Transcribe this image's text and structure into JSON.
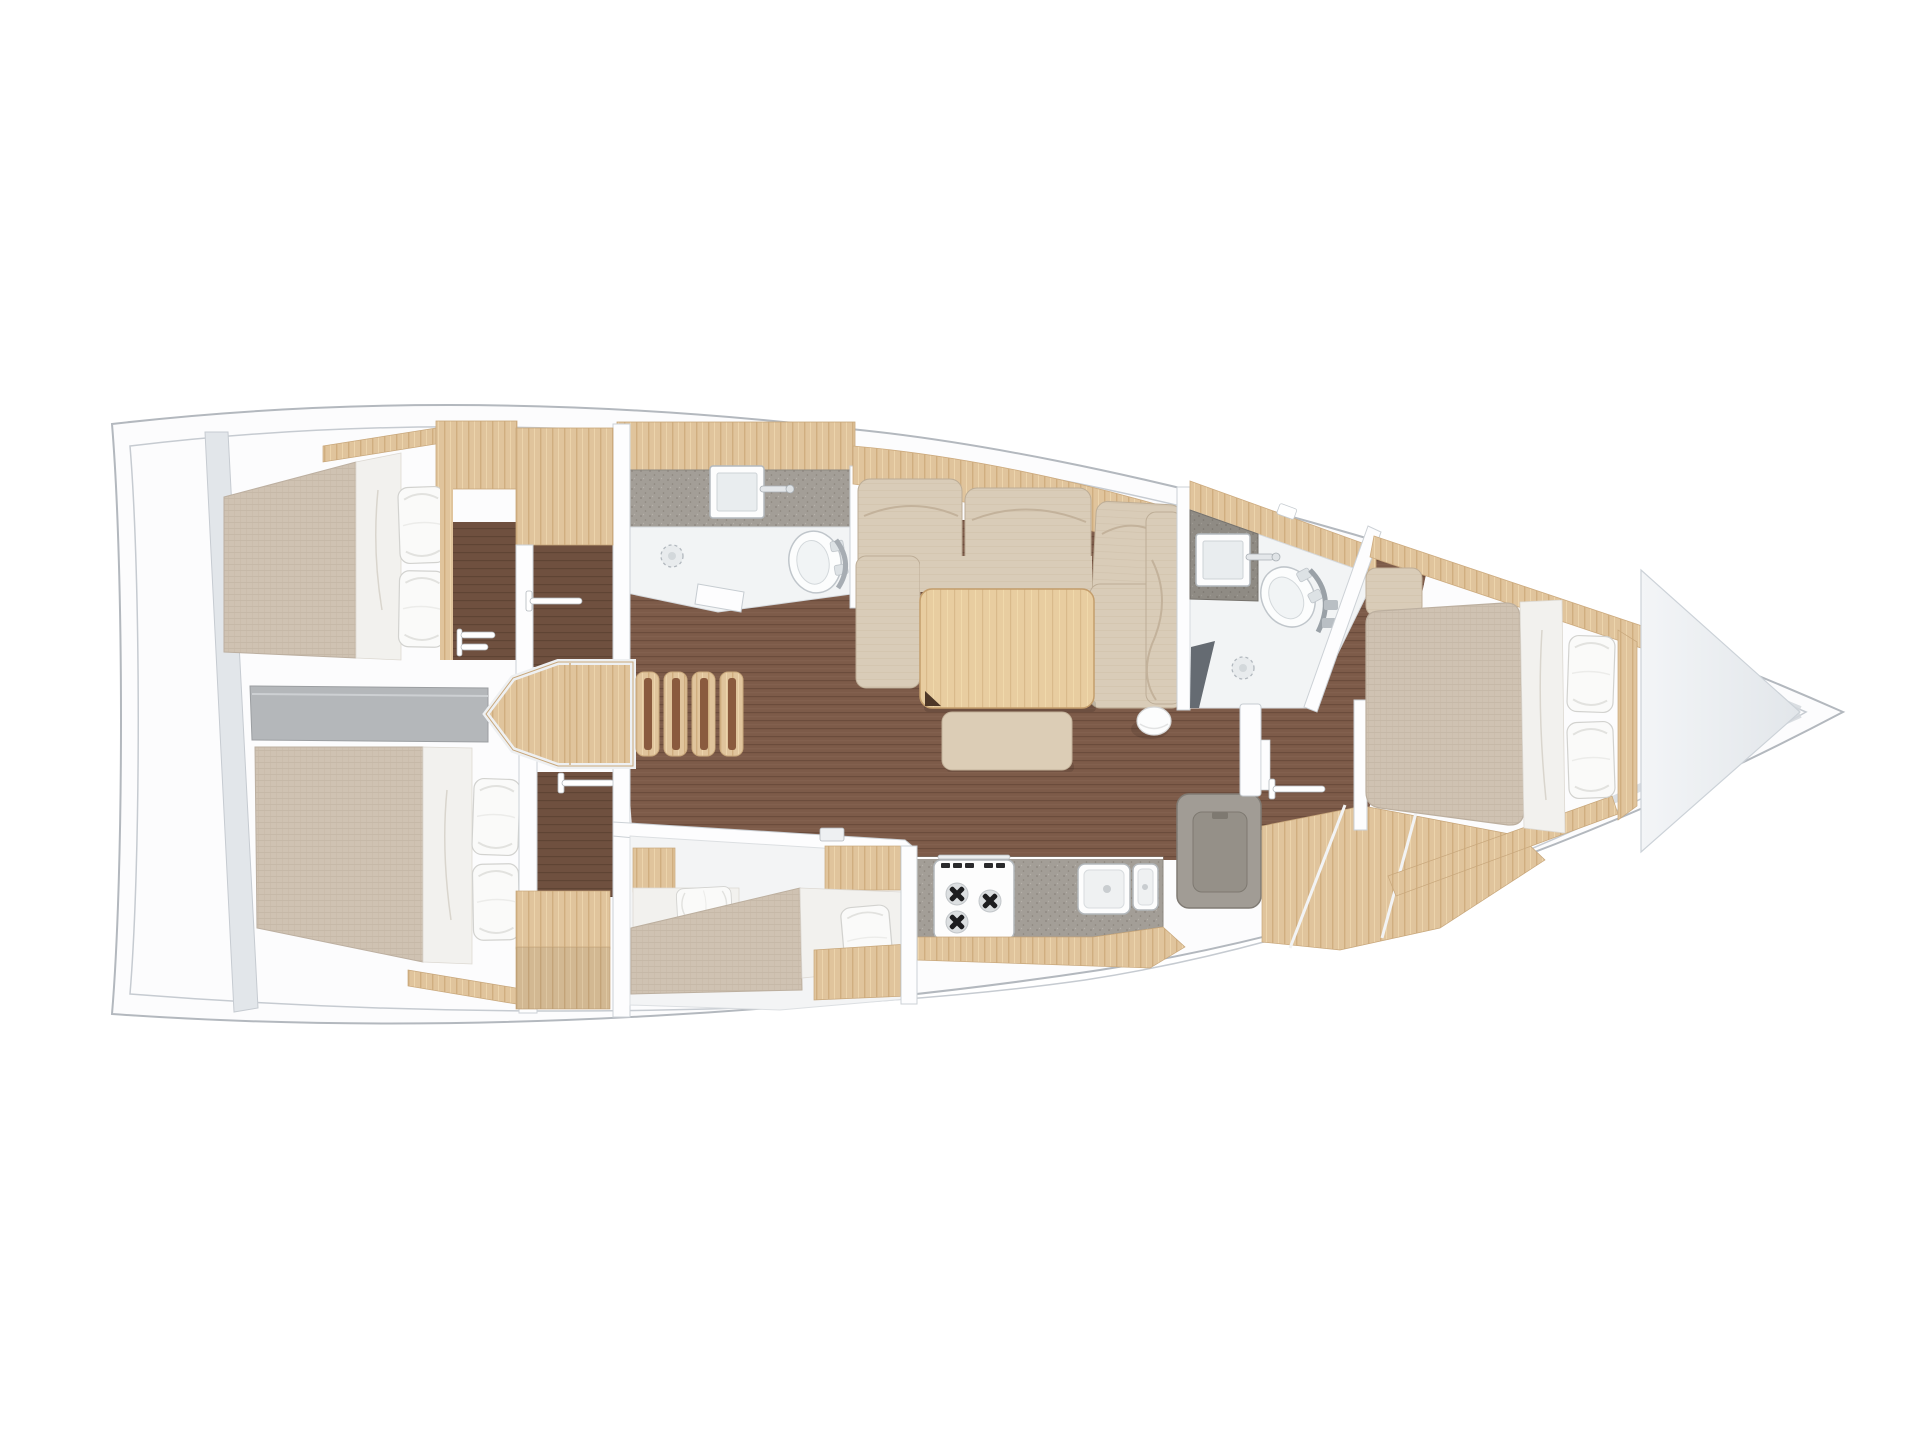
{
  "meta": {
    "type": "yacht-interior-floorplan",
    "view": "top-down-3d-render",
    "bow_direction": "right",
    "visible_text": ""
  },
  "palette": {
    "page_bg": "#ffffff",
    "hull_fill": "#fcfcfd",
    "hull_stroke": "#b3b8be",
    "inner_line": "#c6cbd1",
    "transom_wall": "#e2e6ea",
    "wall_white": "#fdfdfe",
    "wall_stroke": "#ccd1d6",
    "walkway_gray": "#b4b7ba",
    "sole_wood": "#7d5b49",
    "sole_wood_dark": "#6f503f",
    "cabinet_wood": "#e0c49c",
    "wood_edge": "#c8a77b",
    "table_wood": "#e8cda0",
    "mattress_beige": "#cfc2b2",
    "sofa_beige": "#d9ccb8",
    "bench_beige": "#dccdb6",
    "bedding_white": "#f2f1ee",
    "pillow_white": "#fafaf9",
    "counter_gray": "#a39e97",
    "counter_dark_gray": "#8f8b84",
    "fixture_white": "#fcfdfd",
    "fixture_stroke": "#c0c6cb",
    "fridge_gray": "#a19c95",
    "shower_screen": "#656b72",
    "bathroom_floor": "#f2f4f5",
    "step_stripe": "#8a5a3e",
    "bow_v": "#eceef1"
  },
  "rooms": [
    {
      "id": "aft-cabin-port",
      "label": "Aft cabin port",
      "fixtures": [
        "double berth",
        "2 pillows",
        "hanging locker",
        "cabinet"
      ]
    },
    {
      "id": "aft-cabin-starboard",
      "label": "Aft cabin starboard",
      "fixtures": [
        "double berth",
        "2 pillows",
        "hanging locker",
        "seat"
      ]
    },
    {
      "id": "companionway",
      "label": "Companionway",
      "fixtures": [
        "landing platform",
        "4 steps"
      ]
    },
    {
      "id": "aft-head",
      "label": "Aft head",
      "fixtures": [
        "washbasin",
        "toilet",
        "shower drain",
        "counter",
        "door"
      ]
    },
    {
      "id": "salon",
      "label": "Salon",
      "fixtures": [
        "U-sofa",
        "dining table",
        "bench",
        "pouf"
      ]
    },
    {
      "id": "galley",
      "label": "Galley",
      "fixtures": [
        "3-burner stove",
        "double sink",
        "top-load fridge"
      ]
    },
    {
      "id": "mid-cabin",
      "label": "Mid bunk cabin",
      "fixtures": [
        "two berths",
        "2 pillows"
      ]
    },
    {
      "id": "forward-head",
      "label": "Forward head",
      "fixtures": [
        "washbasin",
        "toilet",
        "shower drain",
        "shower screen",
        "door",
        "hanging rod"
      ]
    },
    {
      "id": "forward-cabin",
      "label": "Forward cabin",
      "fixtures": [
        "island berth",
        "2 pillows",
        "side shelves"
      ]
    },
    {
      "id": "bow-locker",
      "label": "Bow anchor locker",
      "fixtures": []
    }
  ]
}
